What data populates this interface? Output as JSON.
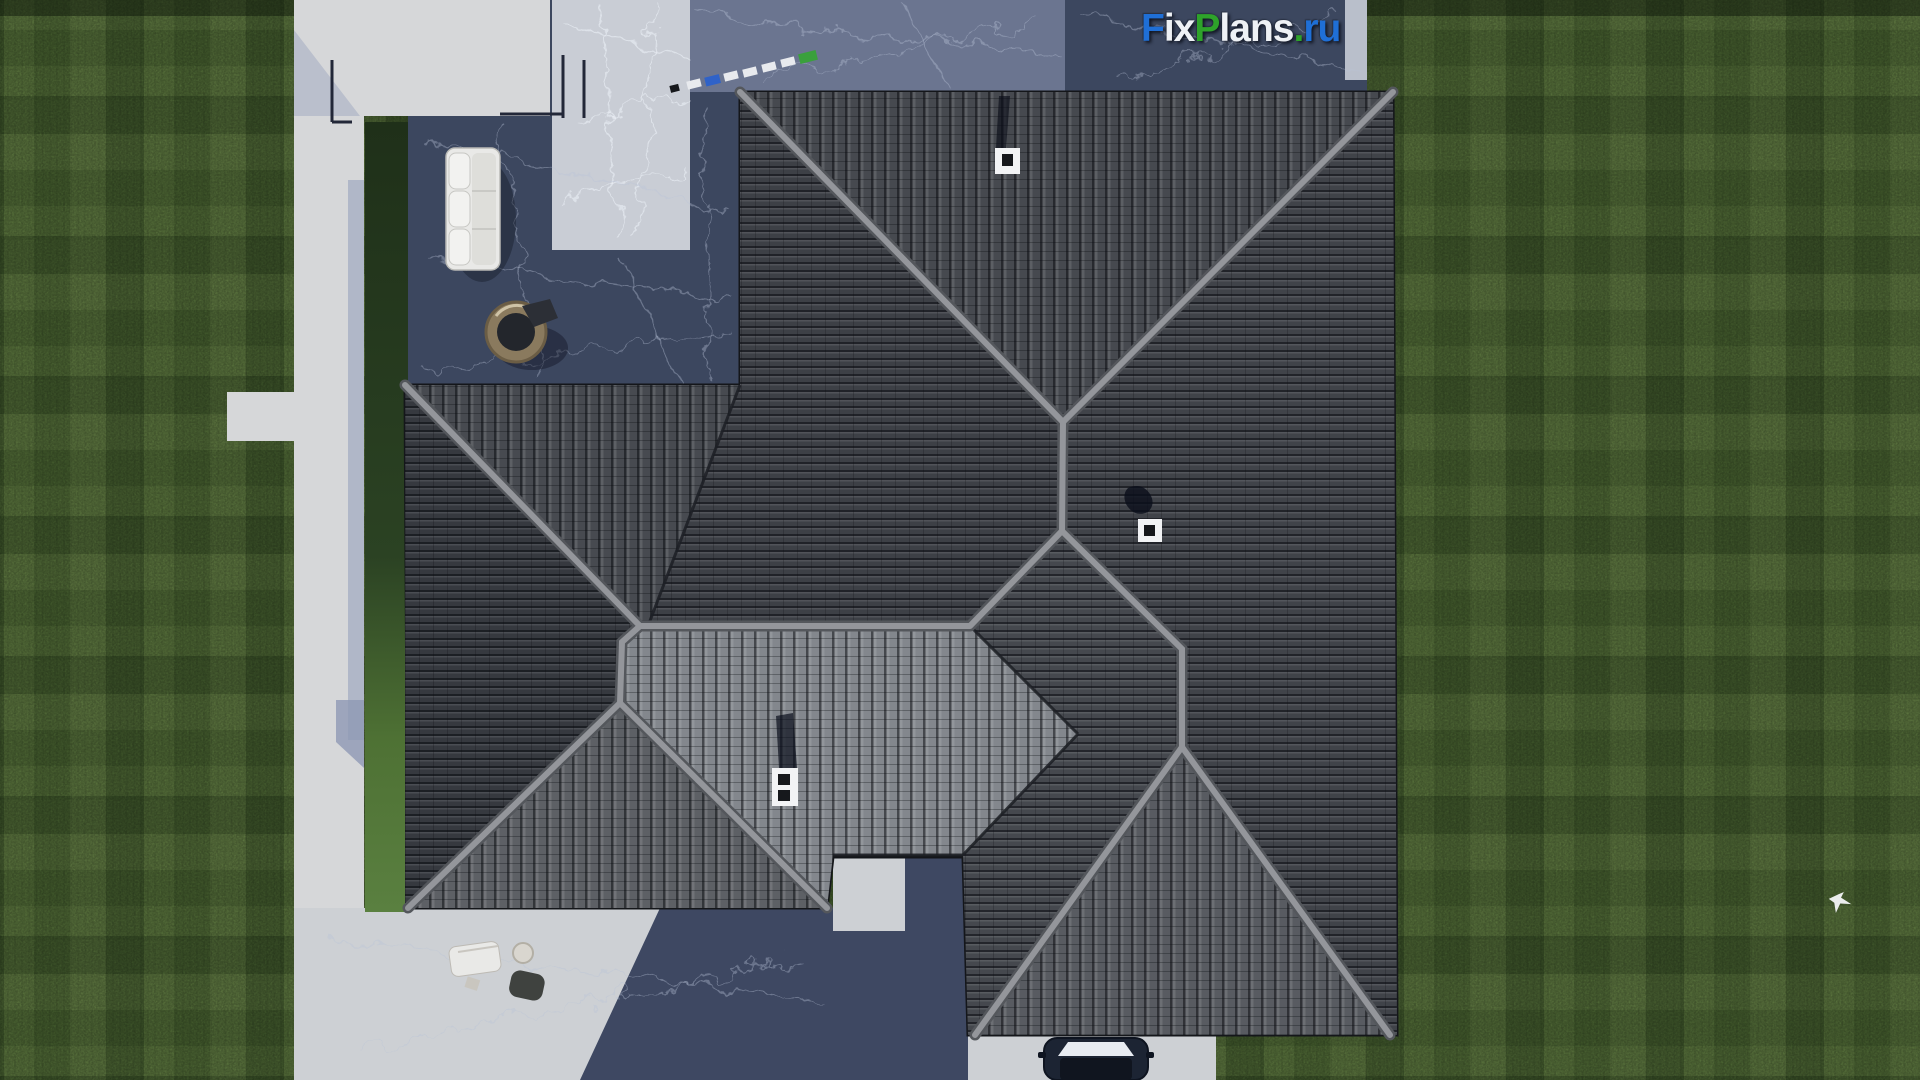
{
  "watermark": {
    "full_text": "FixPlans.ru",
    "parts": [
      {
        "text": "F",
        "style": "color:#1f6fd6"
      },
      {
        "text": "i",
        "style": "color:#eef1f5"
      },
      {
        "text": "x",
        "style": "color:#eef1f5"
      },
      {
        "text": "P",
        "style": "color:#2ea32a"
      },
      {
        "text": "l",
        "style": "color:#eef1f5"
      },
      {
        "text": "a",
        "style": "color:#eef1f5"
      },
      {
        "text": "n",
        "style": "color:#eef1f5"
      },
      {
        "text": "s",
        "style": "color:#eef1f5"
      },
      {
        "text": ".",
        "style": "color:#2ea32a"
      },
      {
        "text": "r",
        "style": "color:#1f6fd6"
      },
      {
        "text": "u",
        "style": "color:#1f6fd6"
      }
    ]
  },
  "palette": {
    "grass_base": "#617f42",
    "grass_strip_dark": "#273d20",
    "grass_strip_light": "#567a39",
    "concrete": "#d6d7d9",
    "concrete_dim": "#cdd0d4",
    "concrete_shadow": "#a9b1c4",
    "marble_bright": "#c9cdd5",
    "marble_mid": "#6b7590",
    "marble_shadow": "#3c475f",
    "deep_shadow": "#3e4862",
    "roof_base": "#383b41",
    "roof_north": "#46494f",
    "roof_west_tr": "#3d4046",
    "roof_north_left": "#474a50",
    "roof_west_left": "#36393f",
    "roof_wing_south": "#5d6065",
    "roof_south_bright": "#83878d",
    "roof_east": "#404349",
    "roof_br_nw": "#45484e",
    "roof_br_south": "#585b61",
    "ridge_light": "#94969b",
    "ridge_dark": "#54575c",
    "valley": "#1c1f24",
    "chimney_white": "#f2f3f5",
    "chimney_hole": "#16181c",
    "stone_white": "#e8eaee",
    "stone_blue": "#2f62c8",
    "stone_green": "#3aa03c",
    "sofa_white": "#e9e9e7",
    "papasan_ring": "#8a7a5e",
    "cushion_dark": "#23262c",
    "car_body": "#1c2433",
    "car_glass": "#e8ecf2",
    "bird_white": "#f4f6f8"
  }
}
